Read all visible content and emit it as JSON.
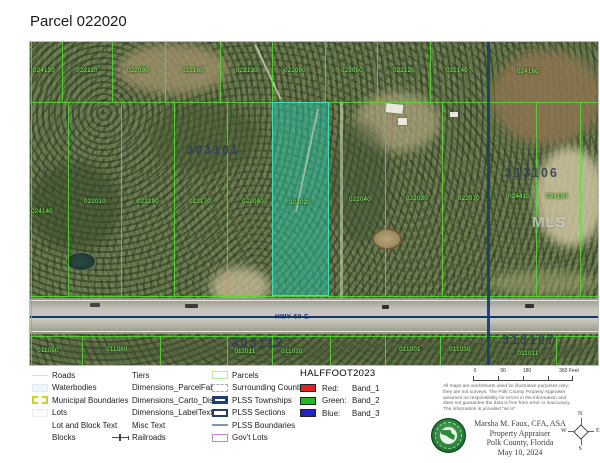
{
  "title": "Parcel 022020",
  "map": {
    "highway_label": "HWY-60-E",
    "watermark": "MLS",
    "highlight_parcel_id": "022020",
    "highlight_color": "#22c6a8",
    "parcel_line_color": "#54dd33",
    "plss_line_color": "#1d3c74",
    "section_labels": [
      {
        "t": "303101",
        "x": 183,
        "y": 108
      },
      {
        "t": "313106",
        "x": 502,
        "y": 131
      },
      {
        "t": "303112",
        "x": 228,
        "y": 301
      },
      {
        "t": "313107",
        "x": 499,
        "y": 298
      }
    ],
    "parcel_labels": [
      {
        "t": "024130",
        "x": 14,
        "y": 29
      },
      {
        "t": "022110",
        "x": 57,
        "y": 29
      },
      {
        "t": "022090",
        "x": 108,
        "y": 29
      },
      {
        "t": "022160",
        "x": 163,
        "y": 29
      },
      {
        "t": "022130",
        "x": 217,
        "y": 29
      },
      {
        "t": "022060",
        "x": 265,
        "y": 29
      },
      {
        "t": "022050",
        "x": 322,
        "y": 29
      },
      {
        "t": "022120",
        "x": 374,
        "y": 29
      },
      {
        "t": "022140",
        "x": 427,
        "y": 29
      },
      {
        "t": "024160",
        "x": 498,
        "y": 30
      },
      {
        "t": "024140",
        "x": 12,
        "y": 170
      },
      {
        "t": "022010",
        "x": 65,
        "y": 160
      },
      {
        "t": "022190",
        "x": 118,
        "y": 160
      },
      {
        "t": "022170",
        "x": 170,
        "y": 160
      },
      {
        "t": "022080",
        "x": 223,
        "y": 160
      },
      {
        "t": "022020",
        "x": 270,
        "y": 161
      },
      {
        "t": "022040",
        "x": 330,
        "y": 158
      },
      {
        "t": "022030",
        "x": 387,
        "y": 157
      },
      {
        "t": "022070",
        "x": 439,
        "y": 157
      },
      {
        "t": "024410",
        "x": 489,
        "y": 155
      },
      {
        "t": "024180",
        "x": 527,
        "y": 155
      },
      {
        "t": "011050",
        "x": 18,
        "y": 309
      },
      {
        "t": "011060",
        "x": 87,
        "y": 308
      },
      {
        "t": "011011",
        "x": 215,
        "y": 310
      },
      {
        "t": "011020",
        "x": 262,
        "y": 310
      },
      {
        "t": "011001",
        "x": 380,
        "y": 308
      },
      {
        "t": "011030",
        "x": 430,
        "y": 308
      },
      {
        "t": "011011",
        "x": 498,
        "y": 312
      }
    ]
  },
  "legend": {
    "columns": [
      {
        "items": [
          {
            "label": "Roads",
            "icon": "road-line"
          },
          {
            "label": "Waterbodies",
            "icon": "water"
          },
          {
            "label": "Municipal Boundaries",
            "icon": "municipal"
          },
          {
            "label": "Lots",
            "icon": "lots"
          },
          {
            "label": "Lot and Block Text",
            "icon": "none"
          },
          {
            "label": "Blocks",
            "icon": "none"
          }
        ]
      },
      {
        "items": [
          {
            "label": "Tiers",
            "icon": "none"
          },
          {
            "label": "Dimensions_ParcelFabric",
            "icon": "none"
          },
          {
            "label": "Dimensions_Carto_Dist",
            "icon": "none"
          },
          {
            "label": "Dimensions_LabelText",
            "icon": "none"
          },
          {
            "label": "Misc Text",
            "icon": "none"
          },
          {
            "label": "Railroads",
            "icon": "railroad"
          }
        ]
      },
      {
        "items": [
          {
            "label": "Parcels",
            "icon": "parcels"
          },
          {
            "label": "Surrounding Counties",
            "icon": "counties"
          },
          {
            "label": "PLSS Townships",
            "icon": "townships"
          },
          {
            "label": "PLSS Sections",
            "icon": "sections"
          },
          {
            "label": "PLSS Boundaries",
            "icon": "plss-line"
          },
          {
            "label": "Gov't Lots",
            "icon": "govt-lots"
          }
        ]
      }
    ],
    "raster": {
      "title": "HALFFOOT2023",
      "bands": [
        {
          "channel": "Red:",
          "band": "Band_1",
          "color": "#e32222"
        },
        {
          "channel": "Green:",
          "band": "Band_2",
          "color": "#22b822"
        },
        {
          "channel": "Blue:",
          "band": "Band_3",
          "color": "#2222cc"
        }
      ]
    }
  },
  "scalebar": {
    "ticks": [
      {
        "label": "0",
        "pos": 2
      },
      {
        "label": "90",
        "pos": 30
      },
      {
        "label": "180",
        "pos": 54
      },
      {
        "label": "360 Feet",
        "pos": 96
      }
    ]
  },
  "disclaimer": {
    "lines": [
      "All maps are worksheets used for illustrative purposes only;",
      "they are not surveys. The Polk County Property Appraiser",
      "assumes no responsibility for errors in the information and",
      "does not guarantee the data is free from error or inaccuracy.",
      "The information is provided \"as is\"."
    ]
  },
  "attribution": {
    "lines": [
      "Marsha M. Faux, CFA, ASA",
      "Property Appraiser",
      "Polk County, Florida",
      "May 10, 2024"
    ]
  },
  "compass": {
    "n": "N",
    "s": "S",
    "e": "E",
    "w": "W"
  }
}
